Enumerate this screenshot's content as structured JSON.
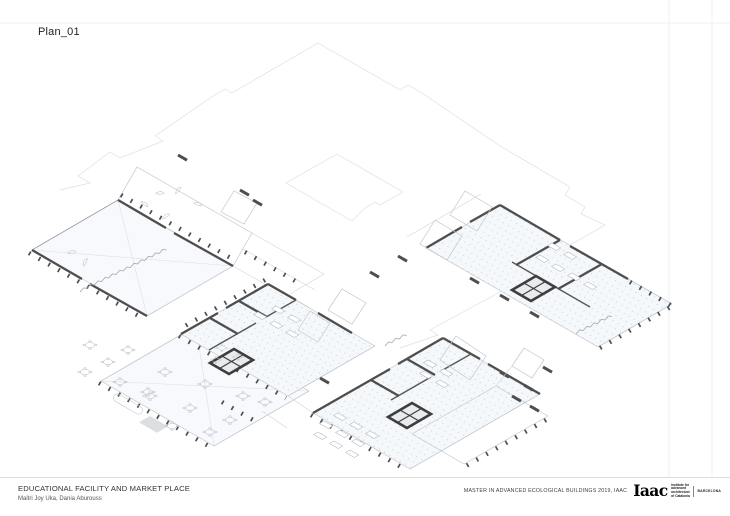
{
  "page": {
    "title": "Plan_01"
  },
  "footer": {
    "project_title": "EDUCATIONAL FACILITY AND MARKET PLACE",
    "authors": "Maitri Joy Uka, Dania Aburouss",
    "program": "MASTER IN ADVANCED ECOLOGICAL BUILDINGS 2019, IAAC",
    "logo": {
      "wordmark": "Iaac",
      "institute_lines": [
        "Institute for",
        "advanced",
        "architecture",
        "of Catalonia"
      ],
      "city": "BARCELONA"
    }
  },
  "colors": {
    "ink": "#1f1f1f",
    "wall": "#4e4e4e",
    "core": "#3e3e3e",
    "edge": "#c2c7cd",
    "faint": "#dcdfe3",
    "floor": "#f7f9fc",
    "floor-dotted": "#f5f8fb",
    "muted": "#555555",
    "rule": "#dedede",
    "grid": "#f0f0f0"
  }
}
